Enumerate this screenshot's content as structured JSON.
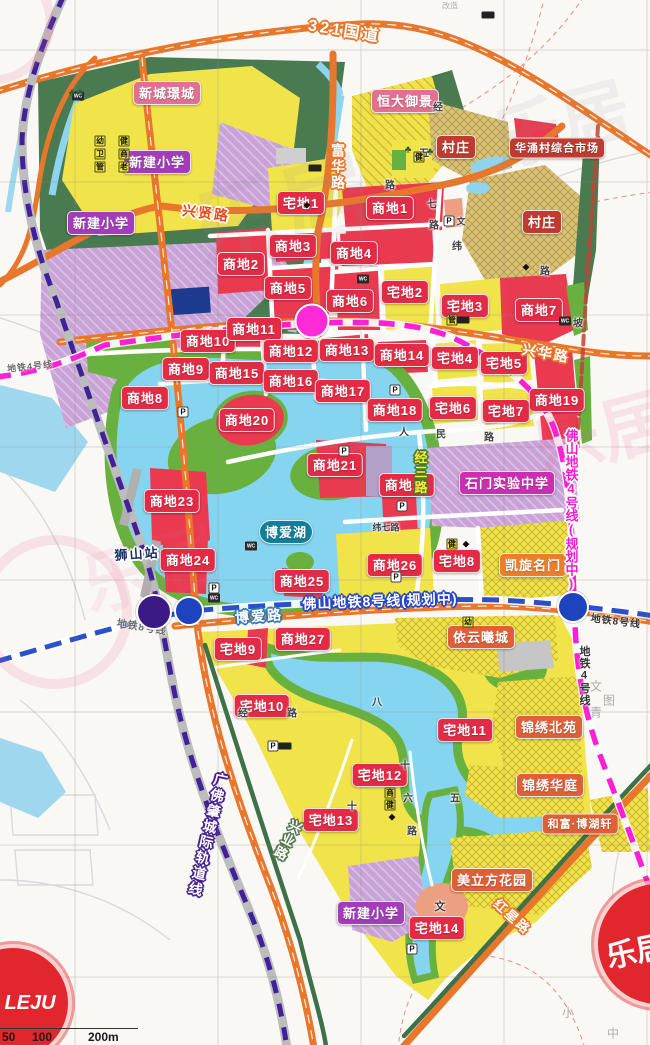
{
  "map": {
    "scale_bar": [
      "50",
      "100",
      "200m"
    ],
    "watermark": {
      "logo": "LEJU",
      "text": "乐居"
    },
    "places": [
      {
        "t": "新城璟城",
        "x": 167,
        "y": 93,
        "c": "pink",
        "n": "label-xincheng-jingcheng"
      },
      {
        "t": "新建小学",
        "x": 157,
        "y": 162,
        "c": "purple",
        "n": "label-new-primary-school-1"
      },
      {
        "t": "新建小学",
        "x": 101,
        "y": 223,
        "c": "purple",
        "n": "label-new-primary-school-2"
      },
      {
        "t": "新建小学",
        "x": 371,
        "y": 913,
        "c": "purple",
        "n": "label-new-primary-school-3"
      },
      {
        "t": "恒大御景",
        "x": 405,
        "y": 101,
        "c": "pink",
        "n": "label-hengda-yujing"
      },
      {
        "t": "村庄",
        "x": 456,
        "y": 147,
        "c": "village",
        "n": "label-village-1"
      },
      {
        "t": "华涌村综合市场",
        "x": 557,
        "y": 148,
        "c": "village",
        "s": 11,
        "n": "label-huayong-market"
      },
      {
        "t": "村庄",
        "x": 542,
        "y": 222,
        "c": "village",
        "n": "label-village-2"
      },
      {
        "t": "石门实验中学",
        "x": 507,
        "y": 483,
        "c": "magenta",
        "n": "label-shimen-school"
      },
      {
        "t": "凯旋名门",
        "x": 533,
        "y": 565,
        "c": "orange",
        "n": "label-kaixuan-mingmen"
      },
      {
        "t": "博爱湖",
        "x": 286,
        "y": 532,
        "c": "teal",
        "n": "label-boai-lake"
      },
      {
        "t": "依云曦城",
        "x": 481,
        "y": 637,
        "c": "rust",
        "n": "label-yiyun-xicheng"
      },
      {
        "t": "锦绣北苑",
        "x": 549,
        "y": 727,
        "c": "rust",
        "n": "label-jinxiu-beiyuan"
      },
      {
        "t": "锦绣华庭",
        "x": 550,
        "y": 785,
        "c": "rust",
        "n": "label-jinxiu-huating"
      },
      {
        "t": "和富·博湖轩",
        "x": 580,
        "y": 824,
        "c": "rust",
        "s": 11,
        "n": "label-hefu-bohuxuan"
      },
      {
        "t": "美立方花园",
        "x": 492,
        "y": 880,
        "c": "rust",
        "n": "label-meilifang-garden"
      }
    ],
    "commercial_parcels": [
      {
        "t": "商地1",
        "x": 390,
        "y": 208
      },
      {
        "t": "商地2",
        "x": 241,
        "y": 264
      },
      {
        "t": "商地3",
        "x": 293,
        "y": 246
      },
      {
        "t": "商地4",
        "x": 354,
        "y": 253
      },
      {
        "t": "商地5",
        "x": 288,
        "y": 288
      },
      {
        "t": "商地6",
        "x": 350,
        "y": 301
      },
      {
        "t": "商地7",
        "x": 539,
        "y": 310
      },
      {
        "t": "商地8",
        "x": 145,
        "y": 398
      },
      {
        "t": "商地9",
        "x": 186,
        "y": 369
      },
      {
        "t": "商地10",
        "x": 208,
        "y": 341
      },
      {
        "t": "商地11",
        "x": 254,
        "y": 329
      },
      {
        "t": "商地12",
        "x": 291,
        "y": 351
      },
      {
        "t": "商地13",
        "x": 347,
        "y": 350
      },
      {
        "t": "商地14",
        "x": 402,
        "y": 355
      },
      {
        "t": "商地15",
        "x": 237,
        "y": 373
      },
      {
        "t": "商地16",
        "x": 291,
        "y": 381
      },
      {
        "t": "商地17",
        "x": 343,
        "y": 391
      },
      {
        "t": "商地18",
        "x": 395,
        "y": 410
      },
      {
        "t": "商地19",
        "x": 557,
        "y": 400
      },
      {
        "t": "商地20",
        "x": 247,
        "y": 420
      },
      {
        "t": "商地21",
        "x": 335,
        "y": 465
      },
      {
        "t": "商地22",
        "x": 407,
        "y": 485
      },
      {
        "t": "商地23",
        "x": 172,
        "y": 501
      },
      {
        "t": "商地24",
        "x": 188,
        "y": 560
      },
      {
        "t": "商地25",
        "x": 302,
        "y": 581
      },
      {
        "t": "商地26",
        "x": 395,
        "y": 565
      },
      {
        "t": "商地27",
        "x": 303,
        "y": 639
      }
    ],
    "residential_parcels": [
      {
        "t": "宅地1",
        "x": 301,
        "y": 203
      },
      {
        "t": "宅地2",
        "x": 405,
        "y": 292
      },
      {
        "t": "宅地3",
        "x": 465,
        "y": 306
      },
      {
        "t": "宅地4",
        "x": 455,
        "y": 358
      },
      {
        "t": "宅地5",
        "x": 504,
        "y": 363
      },
      {
        "t": "宅地6",
        "x": 453,
        "y": 408
      },
      {
        "t": "宅地7",
        "x": 506,
        "y": 411
      },
      {
        "t": "宅地8",
        "x": 457,
        "y": 561
      },
      {
        "t": "宅地9",
        "x": 238,
        "y": 649
      },
      {
        "t": "宅地10",
        "x": 262,
        "y": 706
      },
      {
        "t": "宅地11",
        "x": 465,
        "y": 730
      },
      {
        "t": "宅地12",
        "x": 380,
        "y": 775
      },
      {
        "t": "宅地13",
        "x": 331,
        "y": 820
      },
      {
        "t": "宅地14",
        "x": 437,
        "y": 928
      }
    ],
    "road_labels": [
      {
        "t": "321国道",
        "x": 345,
        "y": 29,
        "r": 9,
        "c": "ol-or",
        "s": 16,
        "ls": 3,
        "n": "road-g321"
      },
      {
        "t": "富华路",
        "x": 338,
        "y": 167,
        "v": true,
        "c": "ol-or",
        "n": "road-fuhua"
      },
      {
        "t": "兴贤路",
        "x": 206,
        "y": 213,
        "r": 7,
        "c": "red-wh",
        "n": "road-xingxian"
      },
      {
        "t": "兴华路",
        "x": 546,
        "y": 353,
        "r": 10,
        "c": "ol-or",
        "n": "road-xinghua"
      },
      {
        "t": "博爱路",
        "x": 259,
        "y": 616,
        "r": -4,
        "c": "ol-tl",
        "n": "road-boai"
      },
      {
        "t": "红星路",
        "x": 513,
        "y": 916,
        "r": 42,
        "c": "ol-or",
        "s": 13,
        "n": "road-hongxing"
      },
      {
        "t": "兴业路",
        "x": 287,
        "y": 840,
        "v": true,
        "r": 28,
        "c": "ol-gr",
        "s": 13,
        "n": "road-xingye"
      },
      {
        "t": "经三路",
        "x": 420,
        "y": 473,
        "v": true,
        "c": "yel-gr",
        "s": 13,
        "n": "road-jingsan"
      },
      {
        "t": "广佛肇城际轨道线",
        "x": 208,
        "y": 835,
        "v": true,
        "r": 13,
        "c": "ol-pu",
        "n": "rail-guangfozhao"
      },
      {
        "t": "佛山地铁8号线(规划中)",
        "x": 380,
        "y": 601,
        "r": -2,
        "c": "ol-bl",
        "s": 14,
        "ls": 1,
        "n": "metro8-label"
      },
      {
        "t": "佛山地铁4号线(规划中)",
        "x": 571,
        "y": 510,
        "v": true,
        "c": "mg-wh",
        "s": 13,
        "ls": 0,
        "n": "metro4-label"
      },
      {
        "t": "地铁8号线",
        "x": 142,
        "y": 626,
        "r": 10,
        "c": "small-grey",
        "n": "metro8-small-west"
      },
      {
        "t": "地铁8号线",
        "x": 616,
        "y": 620,
        "r": 7,
        "c": "small-dark",
        "n": "metro8-small-east"
      },
      {
        "t": "地铁4号线",
        "x": 30,
        "y": 366,
        "r": -6,
        "c": "small-grey",
        "s": 9,
        "n": "metro4-small-west"
      },
      {
        "t": "地铁4号线",
        "x": 584,
        "y": 676,
        "v": true,
        "c": "small-dark",
        "s": 11,
        "n": "metro4-small-east"
      },
      {
        "t": "狮山站",
        "x": 137,
        "y": 553,
        "r": -4,
        "c": "station-name",
        "n": "shishan-station-label"
      }
    ],
    "minor_labels": [
      {
        "t": "人",
        "x": 404,
        "y": 431
      },
      {
        "t": "民",
        "x": 441,
        "y": 433
      },
      {
        "t": "路",
        "x": 489,
        "y": 436
      },
      {
        "t": "纬七路",
        "x": 386,
        "y": 527,
        "s": 9
      },
      {
        "t": "经",
        "x": 438,
        "y": 106
      },
      {
        "t": "五",
        "x": 424,
        "y": 152
      },
      {
        "t": "路",
        "x": 390,
        "y": 184
      },
      {
        "t": "七",
        "x": 432,
        "y": 203
      },
      {
        "t": "路",
        "x": 434,
        "y": 224
      },
      {
        "t": "纬",
        "x": 457,
        "y": 245
      },
      {
        "t": "路",
        "x": 545,
        "y": 270
      },
      {
        "t": "坡",
        "x": 578,
        "y": 322
      },
      {
        "t": "八",
        "x": 377,
        "y": 701
      },
      {
        "t": "经",
        "x": 243,
        "y": 712
      },
      {
        "t": "路",
        "x": 292,
        "y": 712
      },
      {
        "t": "十",
        "x": 405,
        "y": 764
      },
      {
        "t": "六",
        "x": 408,
        "y": 797
      },
      {
        "t": "五",
        "x": 455,
        "y": 797
      },
      {
        "t": "十",
        "x": 352,
        "y": 805
      },
      {
        "t": "路",
        "x": 412,
        "y": 830
      },
      {
        "t": "文",
        "x": 440,
        "y": 906,
        "s": 11
      },
      {
        "t": "文",
        "x": 461,
        "y": 221,
        "s": 9
      },
      {
        "t": "文",
        "x": 596,
        "y": 686,
        "c": "faint",
        "s": 12
      },
      {
        "t": "图",
        "x": 609,
        "y": 700,
        "c": "faint",
        "s": 12
      },
      {
        "t": "青",
        "x": 596,
        "y": 712,
        "c": "faint",
        "s": 12
      },
      {
        "t": "小",
        "x": 568,
        "y": 1012,
        "c": "faint",
        "s": 12
      },
      {
        "t": "中",
        "x": 613,
        "y": 1033,
        "c": "faint",
        "s": 12
      },
      {
        "t": "改造",
        "x": 450,
        "y": 6,
        "c": "faint",
        "s": 8
      }
    ],
    "icons": [
      {
        "t": "p",
        "c": "P",
        "x": 183,
        "y": 412
      },
      {
        "t": "p",
        "c": "P",
        "x": 344,
        "y": 451
      },
      {
        "t": "p",
        "c": "P",
        "x": 395,
        "y": 390
      },
      {
        "t": "p",
        "c": "P",
        "x": 402,
        "y": 506
      },
      {
        "t": "p",
        "c": "P",
        "x": 396,
        "y": 577
      },
      {
        "t": "p",
        "c": "P",
        "x": 214,
        "y": 588
      },
      {
        "t": "p",
        "c": "P",
        "x": 273,
        "y": 746
      },
      {
        "t": "p",
        "c": "P",
        "x": 412,
        "y": 949
      },
      {
        "t": "p",
        "c": "P",
        "x": 449,
        "y": 221
      },
      {
        "t": "wc",
        "c": "WC",
        "x": 251,
        "y": 546
      },
      {
        "t": "wc",
        "c": "WC",
        "x": 363,
        "y": 279
      },
      {
        "t": "wc",
        "c": "WC",
        "x": 214,
        "y": 598
      },
      {
        "t": "wc",
        "c": "WC",
        "x": 565,
        "y": 321
      },
      {
        "t": "wc",
        "c": "WC",
        "x": 78,
        "y": 96
      },
      {
        "t": "box",
        "c": "幼",
        "x": 100,
        "y": 141
      },
      {
        "t": "box",
        "c": "健",
        "x": 124,
        "y": 141
      },
      {
        "t": "box",
        "c": "卫",
        "x": 100,
        "y": 154
      },
      {
        "t": "box",
        "c": "商",
        "x": 124,
        "y": 154
      },
      {
        "t": "box",
        "c": "管",
        "x": 100,
        "y": 167
      },
      {
        "t": "box",
        "c": "老",
        "x": 124,
        "y": 167
      },
      {
        "t": "box",
        "c": "健",
        "x": 419,
        "y": 157
      },
      {
        "t": "box",
        "c": "管",
        "x": 452,
        "y": 320
      },
      {
        "t": "box",
        "c": "幼",
        "x": 468,
        "y": 622
      },
      {
        "t": "box",
        "c": "健",
        "x": 452,
        "y": 544
      },
      {
        "t": "box",
        "c": "商",
        "x": 390,
        "y": 793
      },
      {
        "t": "box",
        "c": "健",
        "x": 390,
        "y": 805
      },
      {
        "t": "tree",
        "c": "♣",
        "x": 72,
        "y": 93
      },
      {
        "t": "tree",
        "c": "♣",
        "x": 80,
        "y": 93
      },
      {
        "t": "tree",
        "c": "♣",
        "x": 408,
        "y": 150
      },
      {
        "t": "tree",
        "c": "♣",
        "x": 430,
        "y": 152
      },
      {
        "t": "dm",
        "c": "◆",
        "x": 526,
        "y": 267
      },
      {
        "t": "dm",
        "c": "◆",
        "x": 307,
        "y": 205
      },
      {
        "t": "dm",
        "c": "◆",
        "x": 392,
        "y": 817
      },
      {
        "t": "dm",
        "c": "◆",
        "x": 466,
        "y": 544
      },
      {
        "t": "bar",
        "x": 315,
        "y": 168
      },
      {
        "t": "bar",
        "x": 285,
        "y": 746
      },
      {
        "t": "bar",
        "x": 463,
        "y": 320
      },
      {
        "t": "bar",
        "x": 488,
        "y": 15
      }
    ],
    "stations": [
      {
        "n": "metro4-station",
        "x": 312,
        "y": 321,
        "d": 31,
        "color": "#ff2bd6"
      },
      {
        "n": "rail-station-shishan",
        "x": 154,
        "y": 612,
        "d": 32,
        "color": "#3b1a86"
      },
      {
        "n": "metro8-station-west",
        "x": 189,
        "y": 611,
        "d": 26,
        "color": "#1e43bd"
      },
      {
        "n": "metro8-station-east",
        "x": 573,
        "y": 607,
        "d": 28,
        "color": "#1e43bd"
      }
    ]
  }
}
